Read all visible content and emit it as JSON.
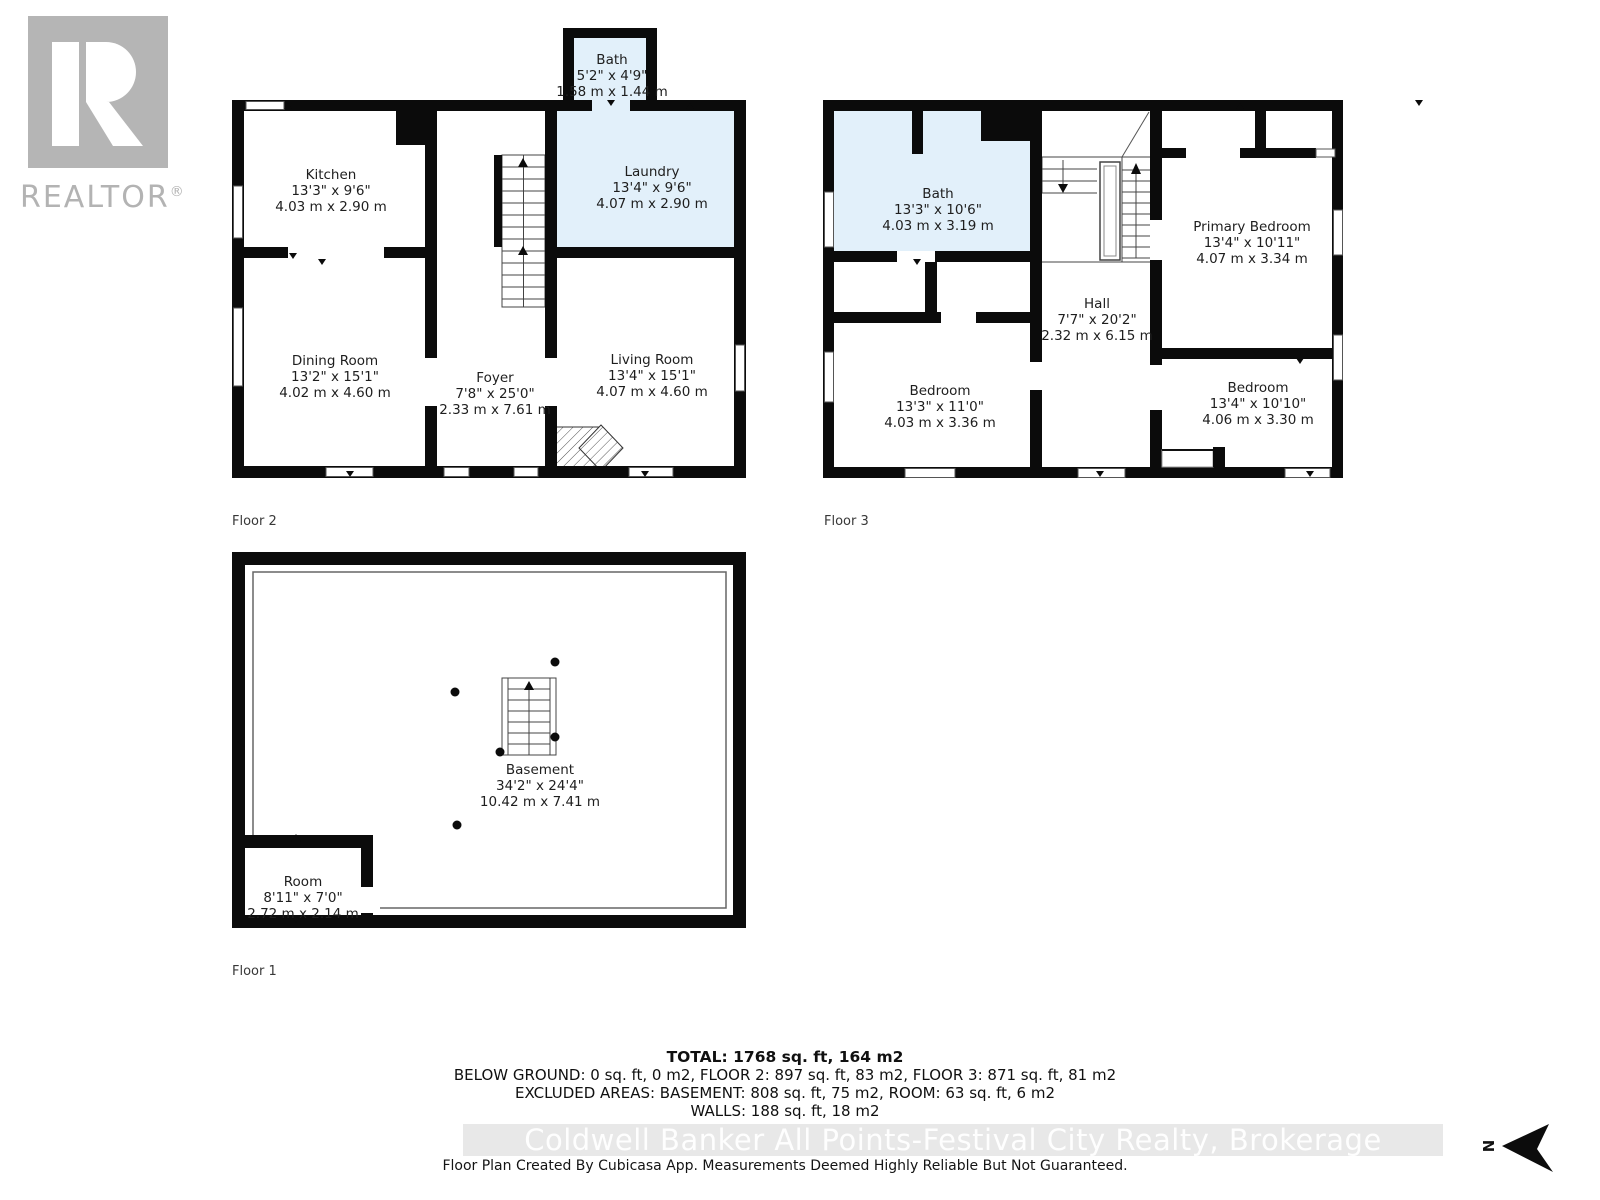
{
  "branding": {
    "realtor_label": "REALTOR",
    "registered_mark": "®"
  },
  "floors": {
    "floor2": {
      "label": "Floor 2"
    },
    "floor3": {
      "label": "Floor 3"
    },
    "floor1": {
      "label": "Floor 1"
    }
  },
  "rooms": {
    "bath_f2": {
      "name": "Bath",
      "imperial": "5'2\" x 4'9\"",
      "metric": "1.58 m x 1.44 m"
    },
    "kitchen": {
      "name": "Kitchen",
      "imperial": "13'3\" x 9'6\"",
      "metric": "4.03 m x 2.90 m"
    },
    "laundry": {
      "name": "Laundry",
      "imperial": "13'4\" x 9'6\"",
      "metric": "4.07 m x 2.90 m"
    },
    "dining": {
      "name": "Dining Room",
      "imperial": "13'2\" x 15'1\"",
      "metric": "4.02 m x 4.60 m"
    },
    "foyer": {
      "name": "Foyer",
      "imperial": "7'8\" x 25'0\"",
      "metric": "2.33 m x 7.61 m"
    },
    "living": {
      "name": "Living Room",
      "imperial": "13'4\" x 15'1\"",
      "metric": "4.07 m x 4.60 m"
    },
    "bath_f3": {
      "name": "Bath",
      "imperial": "13'3\" x 10'6\"",
      "metric": "4.03 m x 3.19 m"
    },
    "primary": {
      "name": "Primary Bedroom",
      "imperial": "13'4\" x 10'11\"",
      "metric": "4.07 m x 3.34 m"
    },
    "hall": {
      "name": "Hall",
      "imperial": "7'7\" x 20'2\"",
      "metric": "2.32 m x 6.15 m"
    },
    "bed_left": {
      "name": "Bedroom",
      "imperial": "13'3\" x 11'0\"",
      "metric": "4.03 m x 3.36 m"
    },
    "bed_right": {
      "name": "Bedroom",
      "imperial": "13'4\" x 10'10\"",
      "metric": "4.06 m x 3.30 m"
    },
    "basement": {
      "name": "Basement",
      "imperial": "34'2\" x 24'4\"",
      "metric": "10.42 m x 7.41 m"
    },
    "room_f1": {
      "name": "Room",
      "imperial": "8'11\" x 7'0\"",
      "metric": "2.72 m x 2.14 m"
    }
  },
  "summary": {
    "total": "TOTAL: 1768 sq. ft, 164 m2",
    "below_ground": "BELOW GROUND: 0 sq. ft, 0 m2, FLOOR 2: 897 sq. ft, 83 m2, FLOOR 3: 871 sq. ft, 81 m2",
    "excluded": "EXCLUDED AREAS: BASEMENT: 808 sq. ft, 75 m2, ROOM: 63 sq. ft, 6 m2",
    "walls": "WALLS: 188 sq. ft, 18 m2"
  },
  "watermark": "Coldwell Banker All Points-Festival City Realty, Brokerage",
  "disclaimer": "Floor Plan Created By Cubicasa App. Measurements Deemed Highly Reliable But Not Guaranteed.",
  "compass": {
    "north_label": "N"
  },
  "colors": {
    "wall": "#0b0b0b",
    "wet_room_fill": "#e2f0fa",
    "logo_gray": "#b3b3b3",
    "watermark_band": "#e8e8e8"
  }
}
